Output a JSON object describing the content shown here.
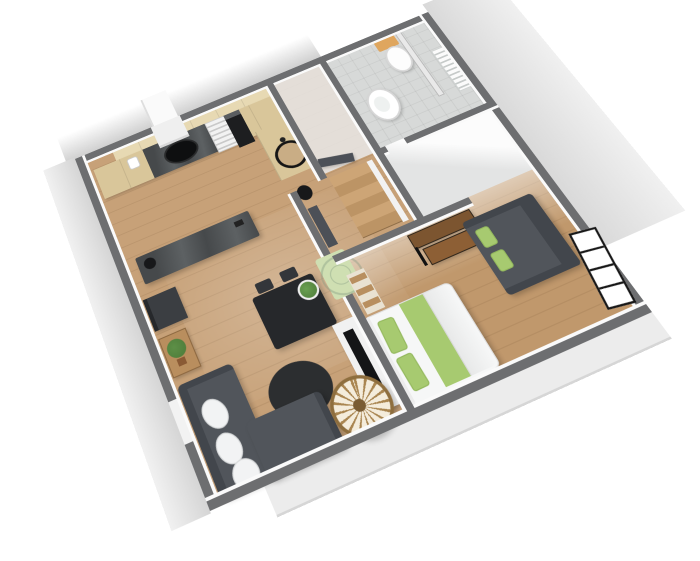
{
  "scene": {
    "type": "3d-floorplan-render",
    "description": "Isometric 3D floor plan of a one-bedroom apartment, rotated, viewed from above",
    "watermark": "faint circular logo watermark at bedroom doorway mat",
    "visible_text": ""
  },
  "colors": {
    "bg": "#ffffff",
    "wall": "#6d6e70",
    "wall-face": "#fafafa",
    "wood-a": "#c7a178",
    "wood-b": "#c0986c",
    "plank": "rgba(80,50,20,0.10)",
    "tile": "#d7d9d8",
    "gray-floor": "#e3e4e4",
    "cabinet": "#d9c69a",
    "cabinet-light": "#e7d9b3",
    "counter": "#46494b",
    "counter-light": "#5d6163",
    "appliance-white": "#e9e9e9",
    "oven-black": "#1d1e20",
    "sofa": "#51555b",
    "sofa-dark": "#42464c",
    "cushion": "#f2f3f4",
    "rug": "#2c2e30",
    "table": "#26282b",
    "desk1": "#7c5530",
    "desk2": "#8d5f35",
    "green": "#a7ca70",
    "green-pale": "#cfdfb2",
    "bed": "#f6f7f7",
    "stairs1": "#cda576",
    "stairs2": "#bc9465",
    "door": "#4c5057",
    "rattan": "#a98550",
    "rattan-bg": "#f4ecdb",
    "toilet-tan": "#dfa65e",
    "porcelain": "#fdfdfd",
    "plant": "#4c7a38",
    "pot": "#8a5a34",
    "watermark": "rgba(125,150,125,0.38)"
  },
  "rooms": [
    {
      "id": "kitchen",
      "floor": "wood"
    },
    {
      "id": "living-room",
      "floor": "wood"
    },
    {
      "id": "stair-vestibule",
      "floor": "wood"
    },
    {
      "id": "bathroom",
      "floor": "tile"
    },
    {
      "id": "storage-room",
      "floor": "gray"
    },
    {
      "id": "bedroom",
      "floor": "wood"
    }
  ],
  "furniture": {
    "kitchen": [
      "upper-cabinets",
      "base-cabinets",
      "range-hood",
      "hood-chimney",
      "cooktop",
      "coffee-maker",
      "dishwasher",
      "oven",
      "counter-l-leg",
      "round-sink",
      "island-bar",
      "island-pot",
      "floor-pot"
    ],
    "stair-vestibule": [
      "staircase",
      "open-door-dark"
    ],
    "bathroom": [
      "toilet",
      "pedestal-sink",
      "towel-radiator",
      "shower-partition"
    ],
    "living-room": [
      "sectional-sofa",
      "sofa-cushions",
      "round-rug",
      "dining-table",
      "table-plant",
      "dining-chairs",
      "console-table",
      "console-plant",
      "sideboard",
      "tv-cabinet",
      "tv",
      "rattan-fan"
    ],
    "bedroom": [
      "double-bed",
      "bed-pillows",
      "green-runner",
      "duvet",
      "desk-two-tier",
      "small-sofa",
      "sofa-pillows",
      "ladder-shelf",
      "door-mat-green",
      "bedroom-door-dark",
      "casement-window"
    ]
  }
}
